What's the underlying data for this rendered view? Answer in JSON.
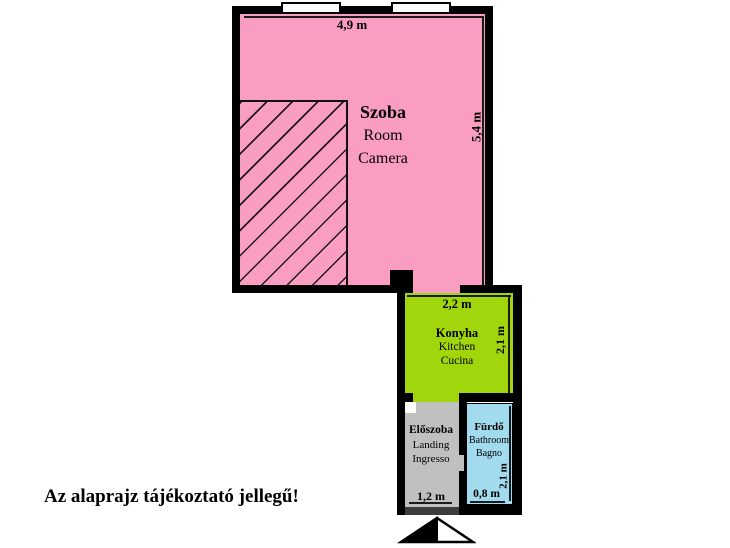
{
  "disclaimer": "Az alaprajz tájékoztató jellegű!",
  "rooms": {
    "szoba": {
      "name": "Szoba",
      "translation_en": "Room",
      "translation_it": "Camera",
      "width": "4,9 m",
      "depth": "5,4 m",
      "color": "#FA9DC3"
    },
    "konyha": {
      "name": "Konyha",
      "translation_en": "Kitchen",
      "translation_it": "Cucina",
      "width": "2,2 m",
      "depth": "2,1 m",
      "color": "#A1D50C"
    },
    "eloszoba": {
      "name": "Előszoba",
      "translation_en": "Landing",
      "translation_it": "Ingresso",
      "width": "1,2 m",
      "color": "#C0C0C0"
    },
    "furdo": {
      "name": "Fürdő",
      "translation_en": "Bathroom",
      "translation_it": "Bagno",
      "width": "0,8 m",
      "depth": "2,1 m",
      "color": "#A3DBEE"
    }
  },
  "icons": {
    "entrance_arrow": "north-arrow-half-filled-triangle",
    "windows": "two-window-openings-top-wall"
  },
  "colors": {
    "wall": "#000000",
    "dim_line": "#1a1a1a",
    "threshold": "#3C3C3C",
    "background": "#FFFFFF"
  }
}
